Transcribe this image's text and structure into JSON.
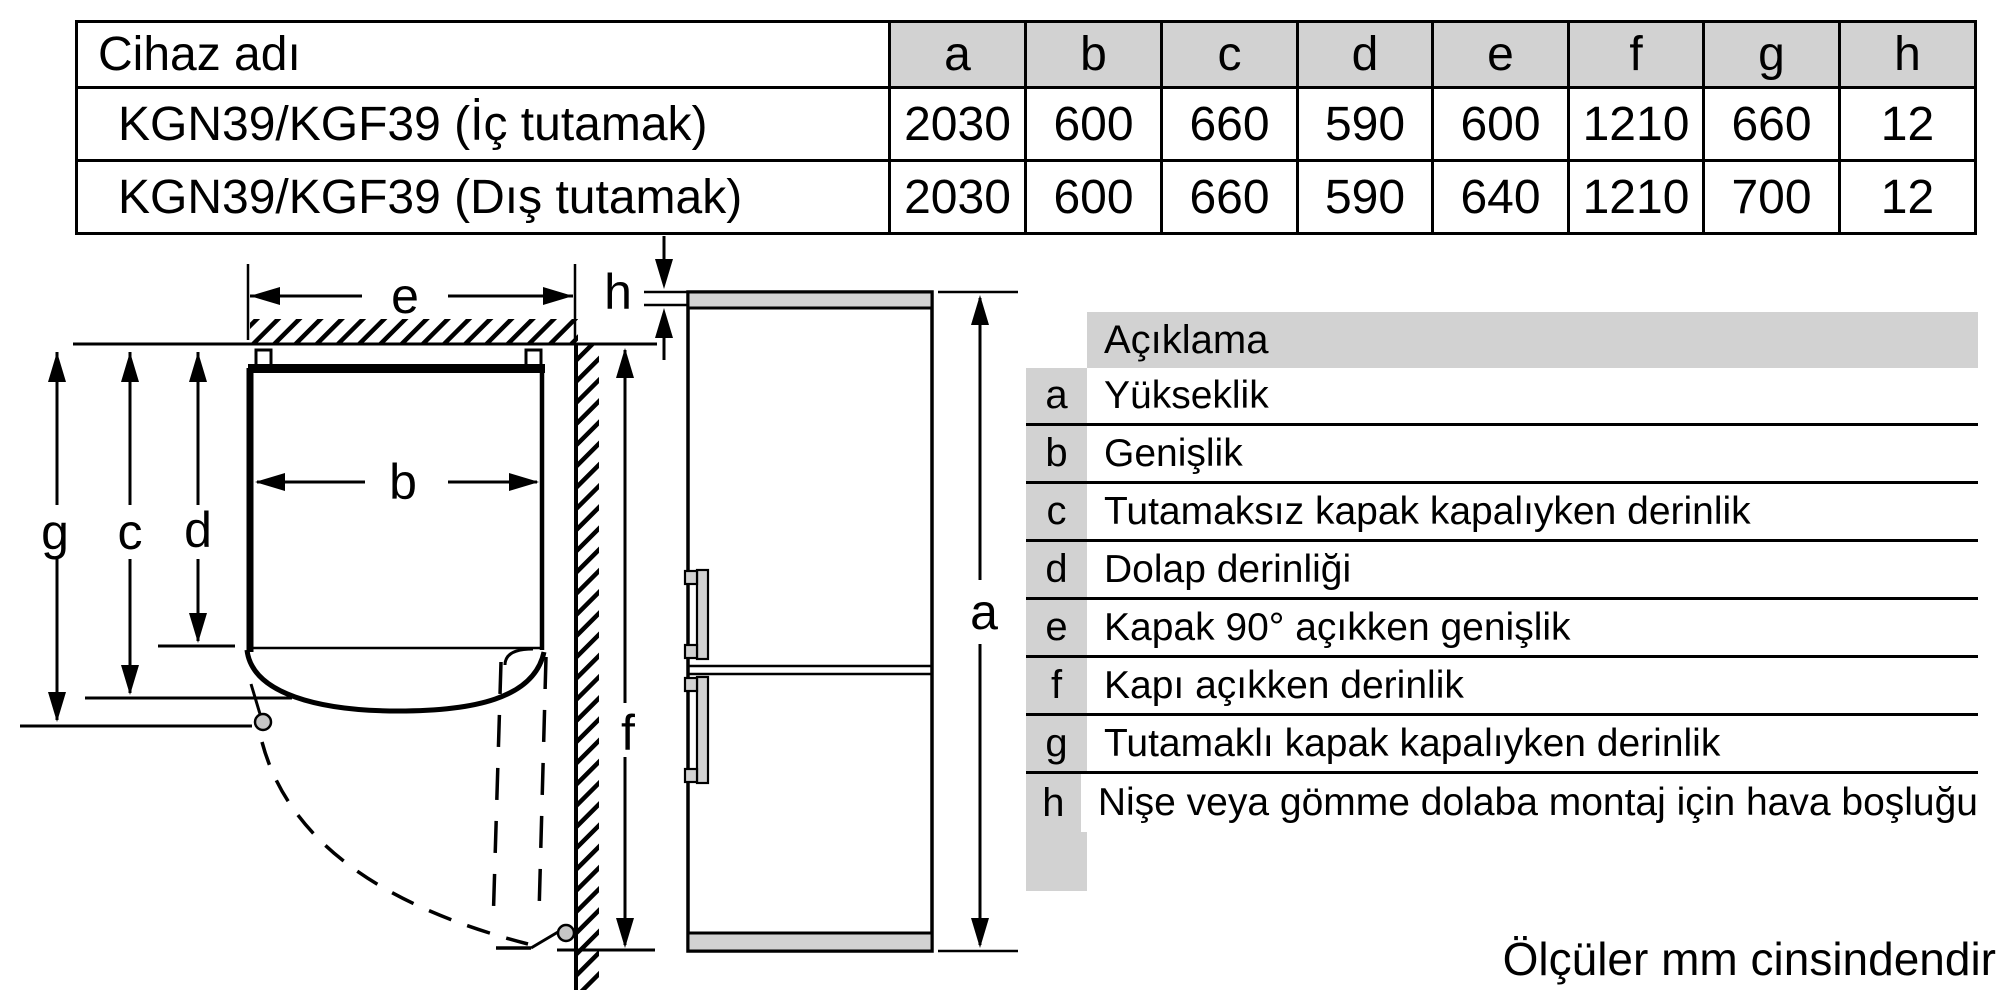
{
  "dimensions_table": {
    "device_col_header": "Cihaz adı",
    "dim_headers": [
      "a",
      "b",
      "c",
      "d",
      "e",
      "f",
      "g",
      "h"
    ],
    "rows": [
      {
        "name": "KGN39/KGF39 (İç tutamak)",
        "values": [
          "2030",
          "600",
          "660",
          "590",
          "600",
          "1210",
          "660",
          "12"
        ]
      },
      {
        "name": "KGN39/KGF39 (Dış tutamak)",
        "values": [
          "2030",
          "600",
          "660",
          "590",
          "640",
          "1210",
          "700",
          "12"
        ]
      }
    ]
  },
  "legend": {
    "header": "Açıklama",
    "rows": [
      {
        "key": "a",
        "label": "Yükseklik"
      },
      {
        "key": "b",
        "label": "Genişlik"
      },
      {
        "key": "c",
        "label": "Tutamaksız kapak kapalıyken derinlik"
      },
      {
        "key": "d",
        "label": "Dolap derinliği"
      },
      {
        "key": "e",
        "label": "Kapak 90° açıkken genişlik"
      },
      {
        "key": "f",
        "label": "Kapı açıkken derinlik"
      },
      {
        "key": "g",
        "label": "Tutamaklı kapak kapalıyken derinlik"
      },
      {
        "key": "h",
        "label": "Nişe veya gömme dolaba montaj için hava boşluğu"
      }
    ]
  },
  "diagram": {
    "labels": {
      "a": "a",
      "b": "b",
      "c": "c",
      "d": "d",
      "e": "e",
      "f": "f",
      "g": "g",
      "h": "h"
    }
  },
  "footer": {
    "note": "Ölçüler mm cinsindendir"
  },
  "colors": {
    "line": "#000000",
    "header_gray": "#d2d2d2",
    "hinge_gray": "#c6c6c6",
    "background": "#ffffff"
  }
}
